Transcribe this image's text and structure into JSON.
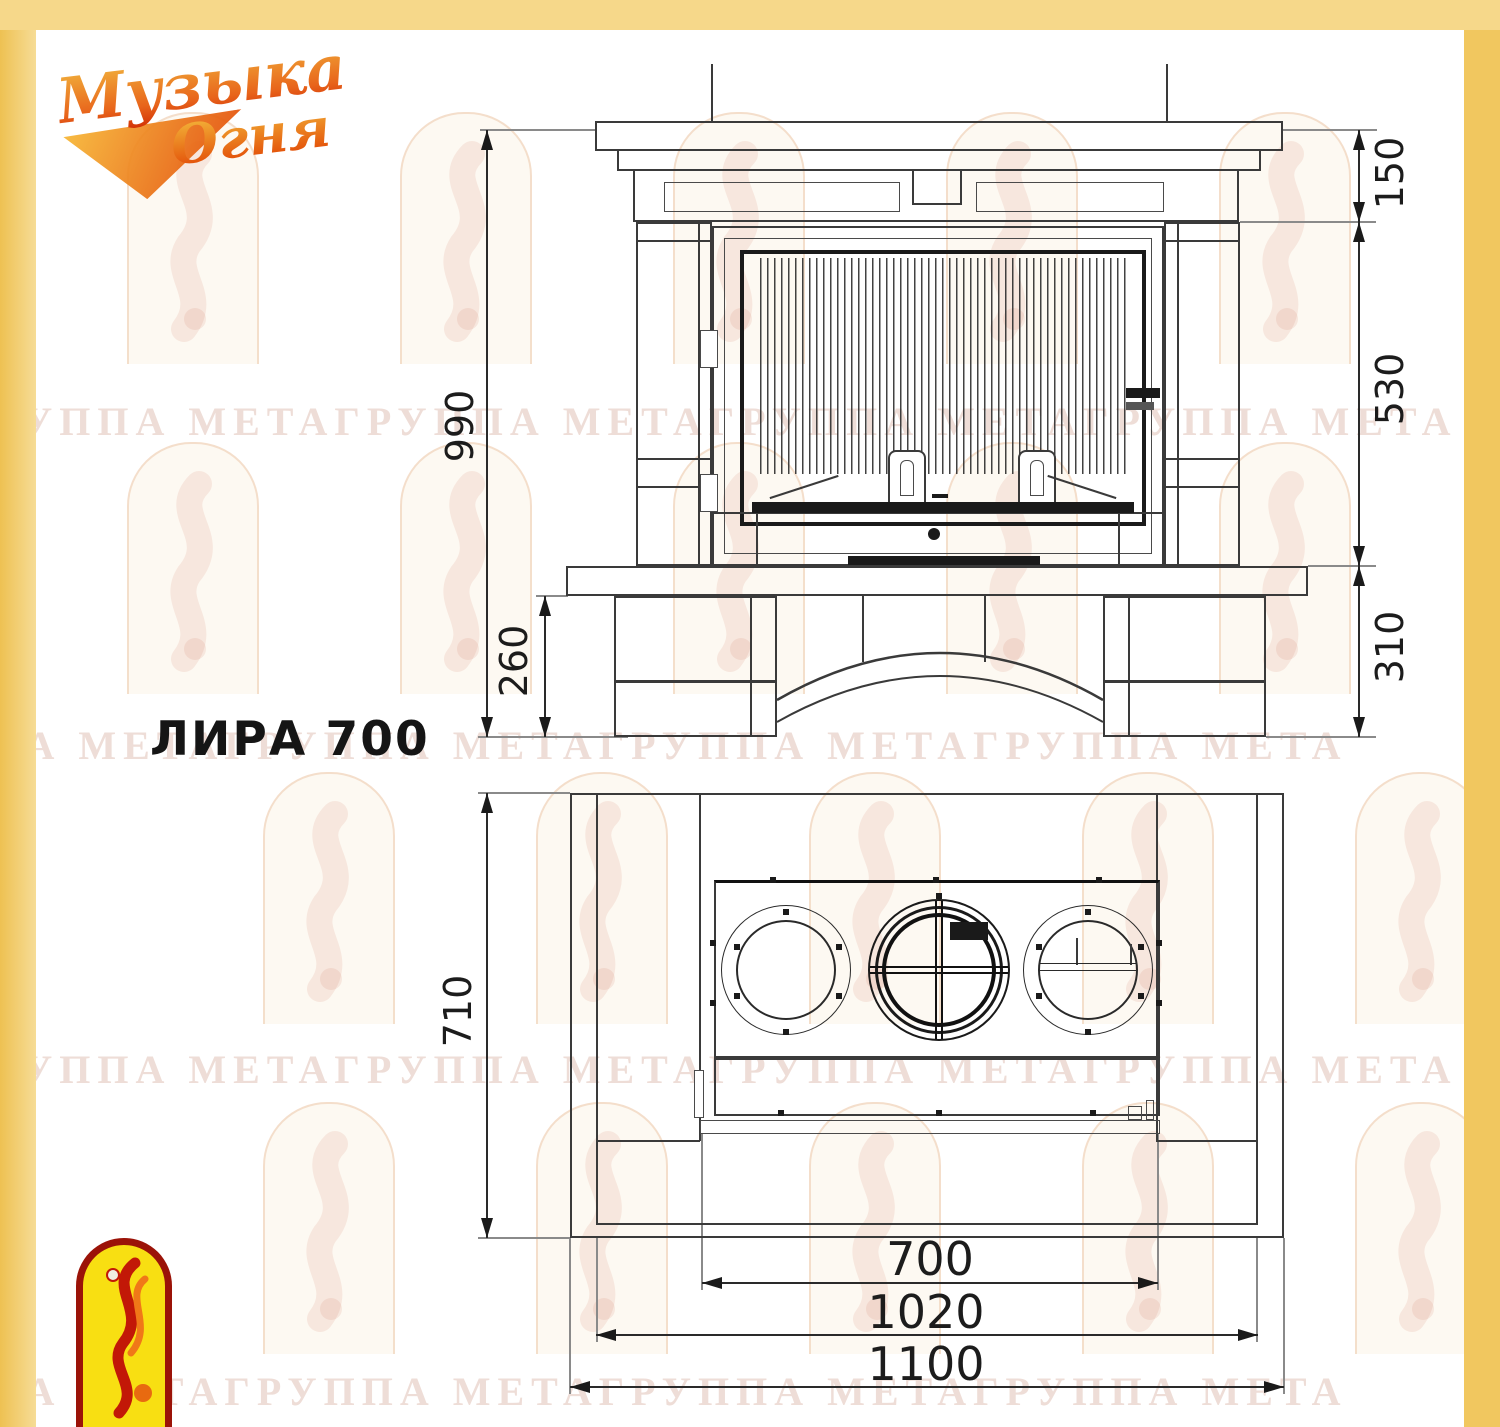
{
  "title": {
    "model": "ЛИРА 700"
  },
  "brand": {
    "logo_top": {
      "line1": "Музыка",
      "line2": "Огня"
    }
  },
  "watermark": {
    "row_text": "ГРУППА МЕТАГРУППА МЕТАГРУППА МЕТАГРУППА МЕТА"
  },
  "front_view": {
    "caption": "front elevation of fireplace",
    "dims": {
      "total_height": "990",
      "mantel_shelf_height": "150",
      "firebox_height": "530",
      "base_height": "310",
      "legs_height": "260"
    }
  },
  "plan_view": {
    "caption": "plan view of fireplace",
    "dims": {
      "depth": "710",
      "firebox_width": "700",
      "inner_width": "1020",
      "total_width": "1100"
    }
  },
  "colors": {
    "frame_top": "#f6d88a",
    "frame_left": "#eec152",
    "frame_right": "#f1c75f",
    "drawing_line": "#3a3a3a",
    "emblem_red": "#9b1308",
    "emblem_yellow": "#f8df12",
    "watermark_text": "rgba(203,150,130,0.32)"
  }
}
